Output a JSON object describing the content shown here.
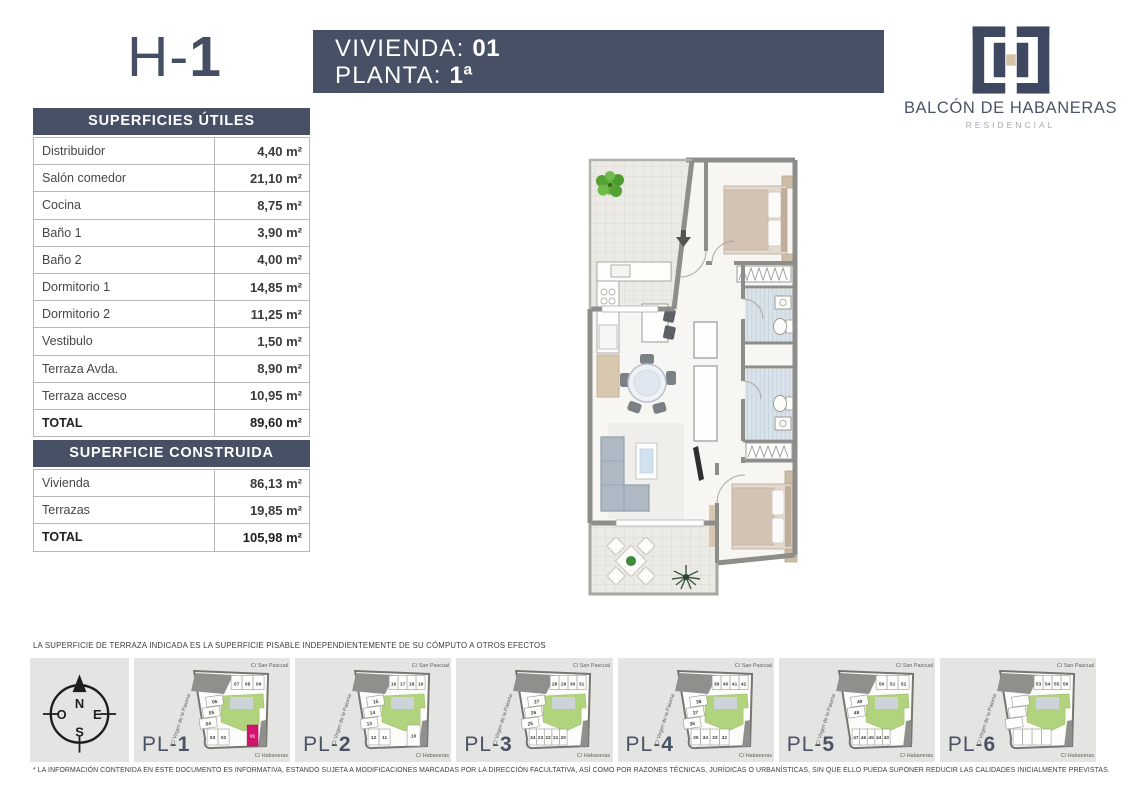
{
  "header": {
    "unit_prefix": "H-",
    "unit_number": "1",
    "vivienda_label": "VIVIENDA:",
    "vivienda_value": "01",
    "planta_label": "PLANTA:",
    "planta_value": "1ª",
    "brand": {
      "name": "BALCÓN DE HABANERAS",
      "subtitle": "RESIDENCIAL"
    }
  },
  "useful_table": {
    "title": "SUPERFICIES ÚTILES",
    "rows": [
      [
        "Distribuidor",
        "4,40 m²"
      ],
      [
        "Salón comedor",
        "21,10 m²"
      ],
      [
        "Cocina",
        "8,75 m²"
      ],
      [
        "Baño 1",
        "3,90 m²"
      ],
      [
        "Baño 2",
        "4,00 m²"
      ],
      [
        "Dormitorio 1",
        "14,85 m²"
      ],
      [
        "Dormitorio 2",
        "11,25 m²"
      ],
      [
        "Vestibulo",
        "1,50 m²"
      ],
      [
        "Terraza Avda.",
        "8,90 m²"
      ],
      [
        "Terraza acceso",
        "10,95 m²"
      ]
    ],
    "total_label": "TOTAL",
    "total_value": "89,60 m²"
  },
  "built_table": {
    "title": "SUPERFICIE CONSTRUIDA",
    "rows": [
      [
        "Vivienda",
        "86,13 m²"
      ],
      [
        "Terrazas",
        "19,85 m²"
      ]
    ],
    "total_label": "TOTAL",
    "total_value": "105,98 m²"
  },
  "terrace_note": "LA SUPERFICIE DE TERRAZA INDICADA ES LA SUPERFICIE PISABLE INDEPENDIENTEMENTE DE SU CÓMPUTO A OTROS EFECTOS",
  "disclaimer": "* LA INFORMACIÓN CONTENIDA EN ESTE DOCUMENTO ES INFORMATIVA, ESTANDO SUJETA A MODIFICACIONES MARCADAS POR LA DIRECCIÓN FACULTATIVA, ASÍ COMO POR RAZONES TÉCNICAS, JURÍDICAS O URBANÍSTICAS, SIN QUE ELLO PUEDA SUPONER REDUCIR LAS CALIDADES INICIALMENTE PREVISTAS.",
  "compass": {
    "north": "N",
    "south": "S",
    "east": "E",
    "west": "O"
  },
  "site_plans": [
    {
      "label_prefix": "PL-",
      "label_number": "1",
      "streets": {
        "top": "C/ San  Pascual",
        "left": "C/ Virgen de la Paloma",
        "bottom": "C/ Habaneras"
      },
      "top_units": [
        "07",
        "08",
        "09"
      ],
      "left_units": [
        "06",
        "05",
        "04"
      ],
      "bottom_units": [
        "03",
        "02"
      ],
      "right_unit": "",
      "highlight_unit": "01"
    },
    {
      "label_prefix": "PL-",
      "label_number": "2",
      "streets": {
        "top": "C/ San  Pascual",
        "left": "C/ Virgen de la Paloma",
        "bottom": "C/ Habaneras"
      },
      "top_units": [
        "16",
        "17",
        "18",
        "19"
      ],
      "left_units": [
        "15",
        "14",
        "13"
      ],
      "bottom_units": [
        "12",
        "11"
      ],
      "right_unit": "10",
      "highlight_unit": ""
    },
    {
      "label_prefix": "PL-",
      "label_number": "3",
      "streets": {
        "top": "C/ San  Pascual",
        "left": "C/ Virgen de la Paloma",
        "bottom": "C/ Habaneras"
      },
      "top_units": [
        "28",
        "29",
        "30",
        "31"
      ],
      "left_units": [
        "27",
        "26",
        "25"
      ],
      "bottom_units": [
        "24",
        "23",
        "22",
        "21",
        "20"
      ],
      "right_unit": "",
      "highlight_unit": ""
    },
    {
      "label_prefix": "PL-",
      "label_number": "4",
      "streets": {
        "top": "C/ San  Pascual",
        "left": "C/ Virgen de la Paloma",
        "bottom": "C/ Habaneras"
      },
      "top_units": [
        "39",
        "40",
        "41",
        "42"
      ],
      "left_units": [
        "38",
        "37",
        "36"
      ],
      "bottom_units": [
        "35",
        "34",
        "33",
        "32"
      ],
      "right_unit": "",
      "highlight_unit": ""
    },
    {
      "label_prefix": "PL-",
      "label_number": "5",
      "streets": {
        "top": "C/ San  Pascual",
        "left": "C/ Virgen de la Paloma",
        "bottom": "C/ Habaneras"
      },
      "top_units": [
        "50",
        "51",
        "52"
      ],
      "left_units": [
        "49",
        "48"
      ],
      "bottom_units": [
        "47",
        "46",
        "45",
        "44",
        "43"
      ],
      "right_unit": "",
      "highlight_unit": ""
    },
    {
      "label_prefix": "PL-",
      "label_number": "6",
      "streets": {
        "top": "C/ San  Pascual",
        "left": "C/ Virgen de la Paloma",
        "bottom": "C/ Habaneras"
      },
      "top_units": [
        "53",
        "54",
        "55",
        "56"
      ],
      "left_units": [],
      "bottom_units": [],
      "right_unit": "",
      "highlight_unit": ""
    }
  ],
  "colors": {
    "slate": "#475065",
    "accent_pink": "#d4156e",
    "courtyard_green": "#b2d37d",
    "logo_navy": "#3e4961",
    "logo_beige": "#d4c3a6",
    "wall_gray": "#8d8d89"
  }
}
